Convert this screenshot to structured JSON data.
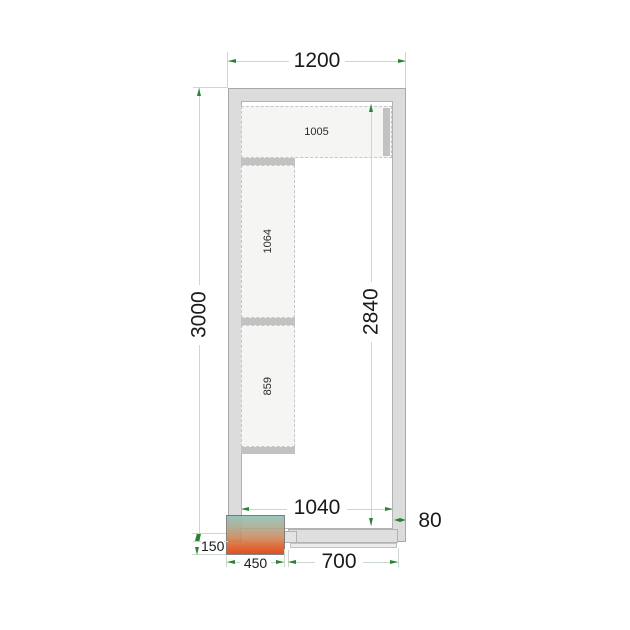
{
  "drawing": {
    "title": "cold-room-floor-plan-top-view",
    "dims": {
      "outer_width": "1200",
      "outer_depth": "3000",
      "inner_depth": "2840",
      "inner_width": "1040",
      "panel_thickness": "80",
      "unit_protrusion": "150",
      "unit_width": "450",
      "door_width": "700"
    },
    "shelves": [
      {
        "label": "1005"
      },
      {
        "label": "1064"
      },
      {
        "label": "859"
      }
    ],
    "colors": {
      "wall_fill": "#dcdcdc",
      "wall_outline": "#a8a8a8",
      "shelf_fill": "#f5f5f3",
      "shelf_outline": "#c6c6c6",
      "shelf_bar": "#c2c2c2",
      "door_fill": "#dfdfdf",
      "dimension_line": "#ccd8cc",
      "arrow_green": "#2a8235",
      "unit_gradient_top": "#8fc2b9",
      "unit_gradient_bottom": "#dd3d0d"
    }
  }
}
